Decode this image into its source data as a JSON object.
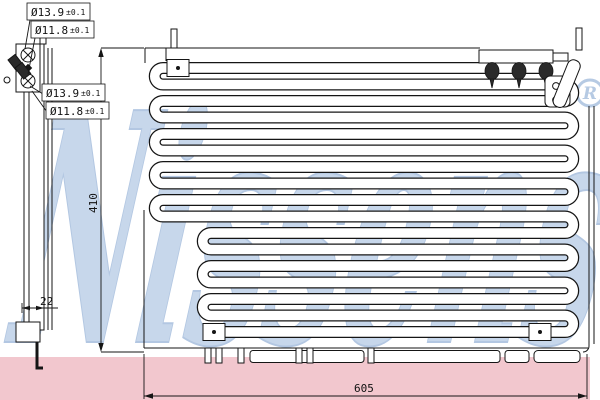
{
  "watermark": {
    "brand": "Nissens",
    "registered": "R",
    "blue": "#b9cde6",
    "band_pink": "#f2c7ce"
  },
  "dimensions": {
    "height": "410",
    "width": "605",
    "depth": "22",
    "port_labels": [
      {
        "value": "Ø13.9",
        "tolerance": "±0.1"
      },
      {
        "value": "Ø11.8",
        "tolerance": "±0.1"
      },
      {
        "value": "Ø13.9",
        "tolerance": "±0.1"
      },
      {
        "value": "Ø11.8",
        "tolerance": "±0.1"
      }
    ]
  },
  "colors": {
    "line": "#151515",
    "background": "#ffffff"
  }
}
